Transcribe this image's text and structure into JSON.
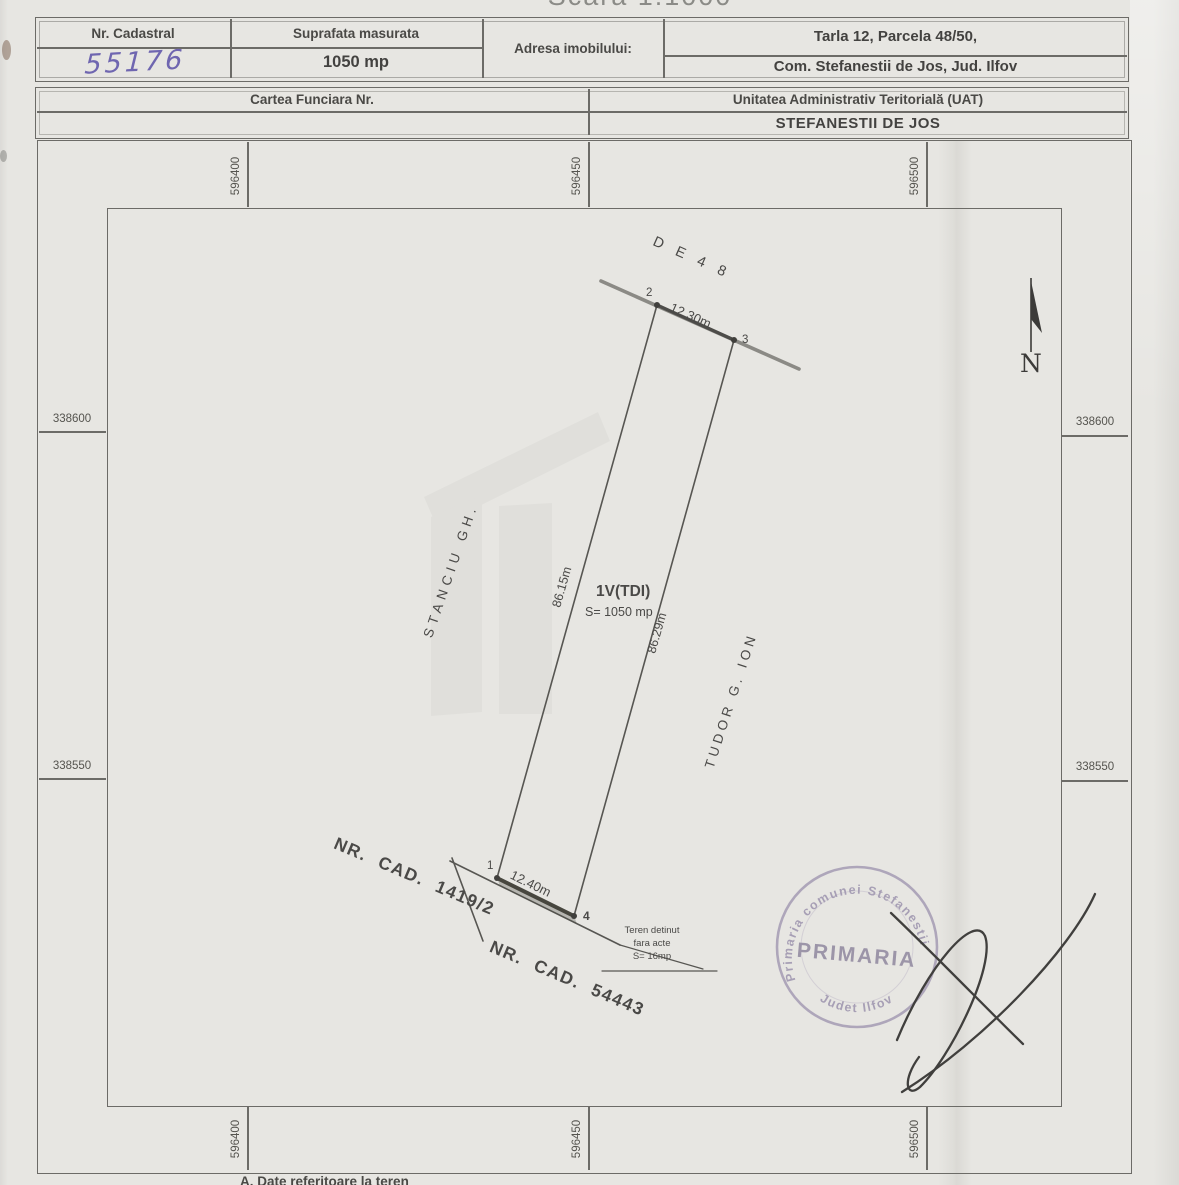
{
  "title": {
    "scale": "Scara 1:1000"
  },
  "header_table": {
    "nr_cadastral_label": "Nr. Cadastral",
    "nr_cadastral_value": "55176",
    "suprafata_label": "Suprafata masurata",
    "suprafata_value": "1050 mp",
    "adresa_label": "Adresa imobilului:",
    "adresa_line1": "Tarla 12, Parcela 48/50,",
    "adresa_line2": "Com. Stefanestii de Jos, Jud. Ilfov",
    "cartea_funciara_label": "Cartea Funciara Nr.",
    "cartea_funciara_value": "",
    "uat_label": "Unitatea Administrativ Teritorială (UAT)",
    "uat_value": "STEFANESTII DE JOS"
  },
  "map": {
    "grid": {
      "top_labels": [
        "596400",
        "596450",
        "596500"
      ],
      "bottom_labels": [
        "596400",
        "596450",
        "596500"
      ],
      "left_labels": [
        "338600",
        "338550"
      ],
      "right_labels": [
        "338600",
        "338550"
      ]
    },
    "parcel": {
      "road_label": "D E  4 8",
      "top_length": "12.30m",
      "left_length": "86.15m",
      "right_length": "86.29m",
      "bottom_length": "12.40m",
      "point_labels": {
        "n1": "1",
        "n2": "2",
        "n3": "3",
        "n4": "4"
      },
      "parcel_id": "1V(TDI)",
      "parcel_area": "S= 1050 mp",
      "neighbor_left": "STANCIU GH.",
      "neighbor_right": "TUDOR G. ION",
      "neighbor_bottom1": "NR.  CAD.  1419/2",
      "neighbor_bottom2": "NR.  CAD.  54443",
      "note_line1": "Teren detinut",
      "note_line2": "fara acte",
      "note_line3": "S= 16mp",
      "north_label": "N"
    },
    "stamp": {
      "arc_top": "Primaria comunei Stefanestii",
      "center_text": "PRIMARIA",
      "arc_bottom": "Judet Ilfov"
    }
  },
  "footer": {
    "caption": "A.  Date  referitoare  la  teren"
  },
  "colors": {
    "paper": "#e7e6e2",
    "line": "#6c6b67",
    "handwriting_ink": "#6f66b0",
    "stamp_ink": "#9d94ae",
    "signature_ink": "#403f3d"
  }
}
